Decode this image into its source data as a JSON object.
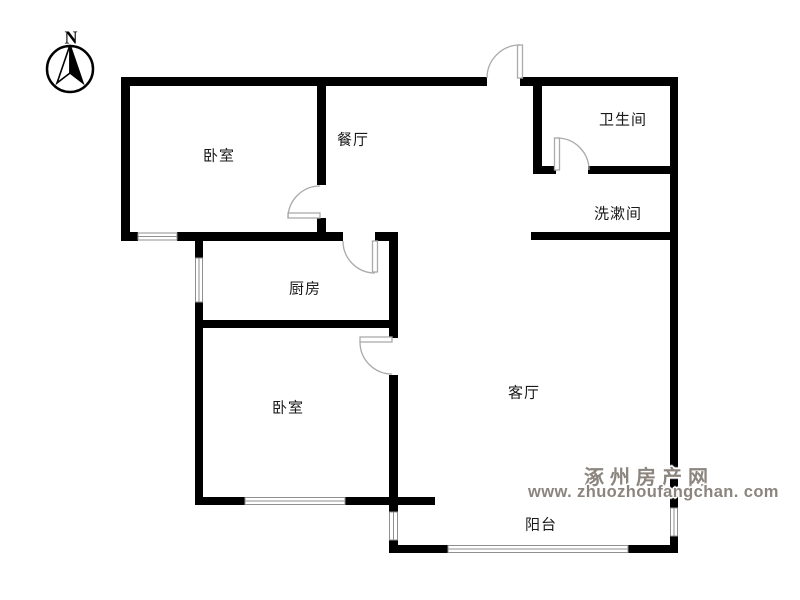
{
  "compass": {
    "north_label": "N"
  },
  "rooms": {
    "bedroom_north": {
      "label": "卧室"
    },
    "dining": {
      "label": "餐厅"
    },
    "bathroom": {
      "label": "卫生间"
    },
    "washroom": {
      "label": "洗漱间"
    },
    "kitchen": {
      "label": "厨房"
    },
    "bedroom_south": {
      "label": "卧室"
    },
    "living": {
      "label": "客厅"
    },
    "balcony": {
      "label": "阳台"
    }
  },
  "watermark": {
    "site_name": "涿州房产网",
    "url_text": "www. zhuozhoufangchan. com"
  },
  "colors": {
    "wall": "#000000",
    "door": "#aaaaaa",
    "window_frame": "#8f8f8f",
    "watermark_text": "#8b857e"
  }
}
